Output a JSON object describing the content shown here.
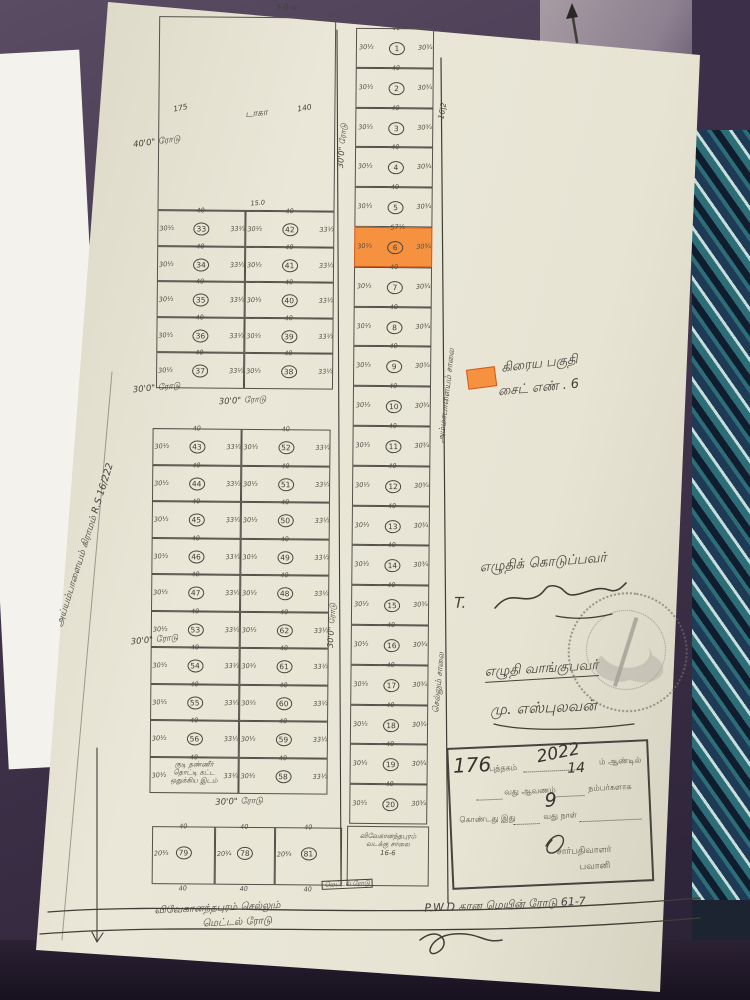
{
  "colors": {
    "paper": "#e9e6d7",
    "ink": "#45423a",
    "highlight": "#f6923f",
    "highlight_border": "#d25a1e",
    "fabric": "#44384e",
    "teal": "#2c6d78"
  },
  "top_section": {
    "top_label": "5-0 வ",
    "dim_left": "175",
    "center_label": "டாகா",
    "dim_right": "140",
    "divider_dim": "15.0"
  },
  "legend": {
    "line1": "கிரைய பகுதி",
    "line2": "சைட் எண் . 6"
  },
  "signatures": {
    "grantor_label": "எழுதிக் கொடுப்பவர்",
    "grantor_initial": "T.",
    "grantee_label": "எழுதி வாங்குபவர்",
    "grantee_name": "மு. எஸ்புலவன்"
  },
  "registration_box": {
    "doc_number": "176",
    "book_label": "புத்தகம்",
    "year": "2022",
    "year_sub": "14",
    "year_suffix": "ம் ஆண்டில்",
    "doc_label": "வது ஆவணம்",
    "numbers_label": "நம்பர்களாக",
    "line3_prefix": "கொண்டது இது",
    "day": "9",
    "line3_suffix": "வது நாள்",
    "officer": "சார்பதிவாளர்",
    "office": "பவானி"
  },
  "roads": {
    "road_40": "40'0\" ரோடு",
    "road_30": "30'0\" ரோடு",
    "bottom_left_1": "விவேகானந்தபுரம் செல்லும்",
    "bottom_left_2": "மெட்டல் ரோடு",
    "metal_box": "மெட்டல் ரோடு",
    "bottom_right": "P.W.D கான மெயின் ரோடு 61-7",
    "side_upper": "அம்மாபாளையம் சாலை",
    "side_lower": "செல்லும் சாலை",
    "survey_mark": "16|2"
  },
  "left_margin_text": "அய்யம்பாளையம் கிராமம் R.S 16/222",
  "plots": {
    "right_column": {
      "numbers": [
        "1",
        "2",
        "3",
        "4",
        "5",
        "6",
        "7",
        "8",
        "9",
        "10",
        "11",
        "12",
        "13",
        "14",
        "15",
        "16",
        "17",
        "18",
        "19",
        "20"
      ],
      "highlight": "6",
      "highlight_top_dim": "57½",
      "side_left": "30½",
      "side_right": "30¾",
      "top_dim": "40"
    },
    "upper_grid": {
      "rows": [
        [
          "33",
          "42"
        ],
        [
          "34",
          "41"
        ],
        [
          "35",
          "40"
        ],
        [
          "36",
          "39"
        ],
        [
          "37",
          "38"
        ]
      ],
      "side_left": "30½",
      "side_right": "33½",
      "top_dim": "40"
    },
    "lower_grid": {
      "rows": [
        [
          "43",
          "52"
        ],
        [
          "44",
          "51"
        ],
        [
          "45",
          "50"
        ],
        [
          "46",
          "49"
        ],
        [
          "47",
          "48"
        ],
        [
          "53",
          "62"
        ],
        [
          "54",
          "61"
        ],
        [
          "55",
          "60"
        ],
        [
          "56",
          "59"
        ],
        [
          "",
          "58"
        ]
      ],
      "side_left": "30½",
      "side_right": "33½",
      "top_dim": "40",
      "text_cell": [
        "குடி தண்ணீர்",
        "தொட்டி கட்ட",
        "ஒதுக்கிய இடம்"
      ]
    },
    "bottom_row": {
      "numbers": [
        "79",
        "78",
        "81"
      ],
      "side": "20¾",
      "top_dim": "40"
    },
    "corner_cell": [
      "விவேகானந்தபுரம்",
      "வடக்கு சாலை",
      "16-6"
    ]
  }
}
